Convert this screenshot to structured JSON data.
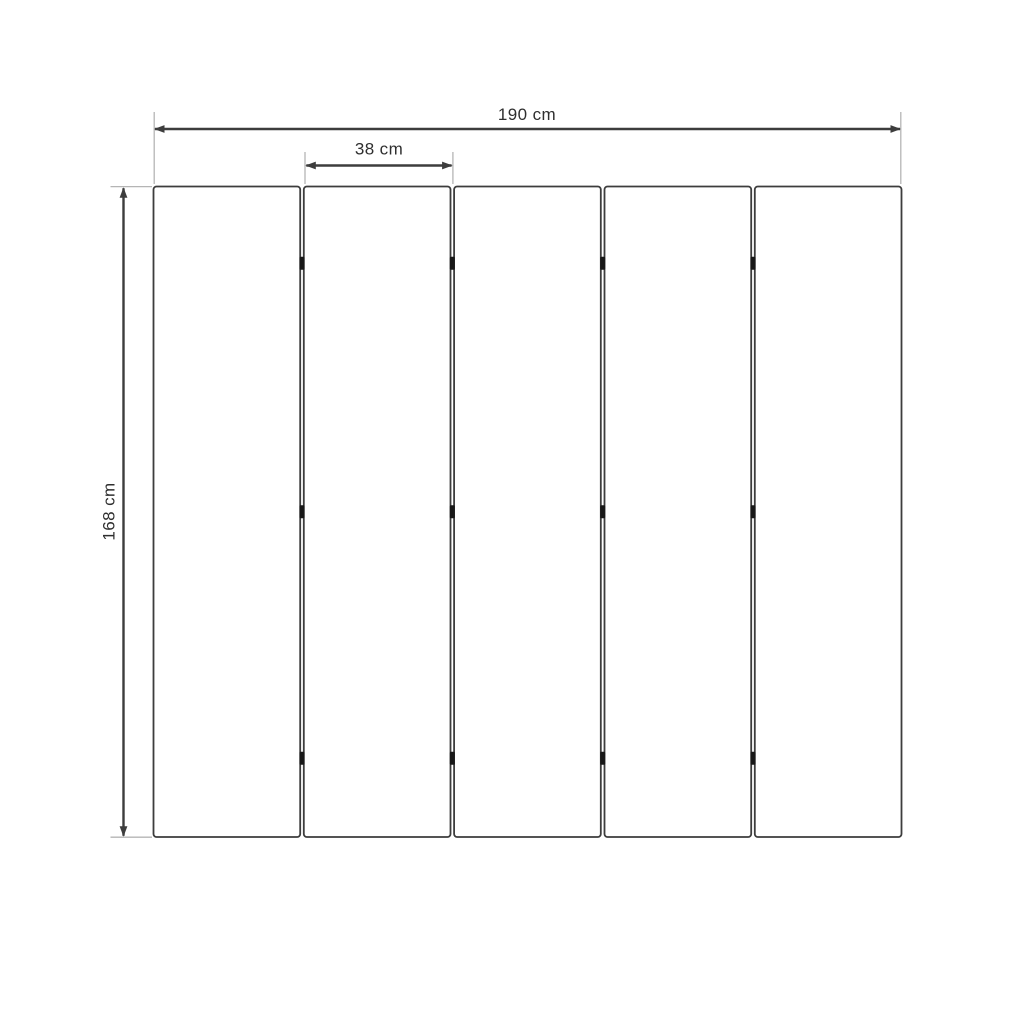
{
  "diagram": {
    "type": "product-dimension-diagram",
    "subject": "five-panel folding screen, front elevation",
    "panel_count": 5,
    "hinge_rows_per_gap": 3,
    "dimensions": {
      "total_width": {
        "label": "190 cm",
        "value": 190,
        "unit": "cm"
      },
      "panel_width": {
        "label": "38 cm",
        "value": 38,
        "unit": "cm"
      },
      "height": {
        "label": "168 cm",
        "value": 168,
        "unit": "cm"
      }
    },
    "colors": {
      "background": "#ffffff",
      "panel_fill": "#ffffff",
      "panel_border": "#3d3d3d",
      "dimension_line": "#3d3d3d",
      "extension_line": "#b5b5b5",
      "hinge": "#181818",
      "text": "#2f2f2f"
    }
  }
}
